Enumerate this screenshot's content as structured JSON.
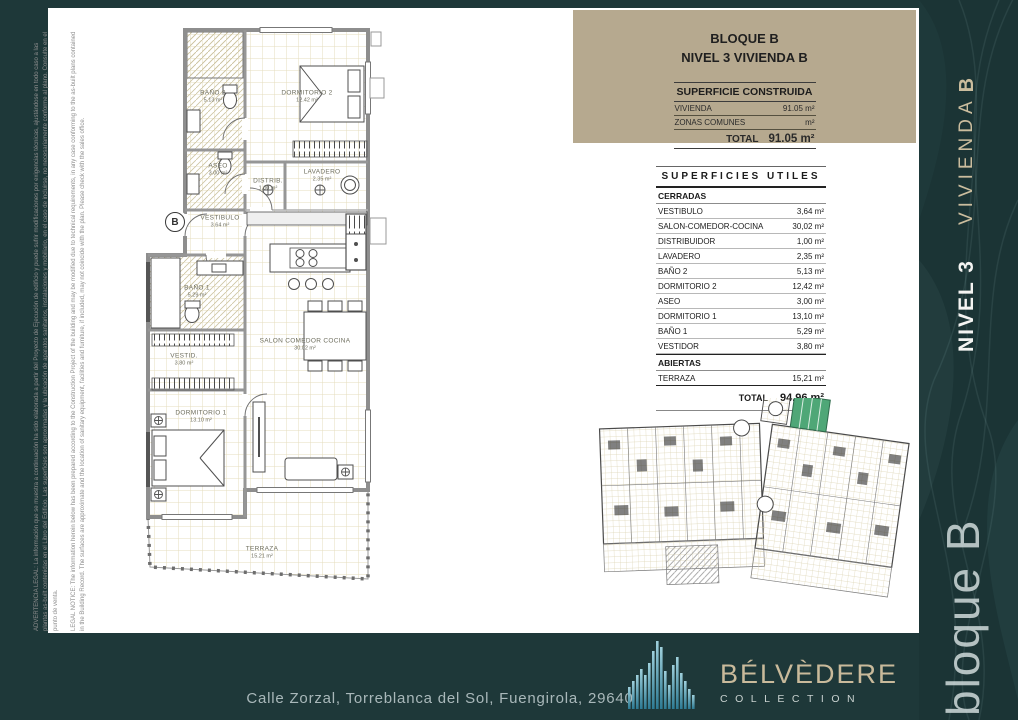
{
  "colors": {
    "teal": "#1e3839",
    "beige": "#b6a98f",
    "highlight_green": "#4fa777"
  },
  "legal": {
    "es": "ADVERTENCIA LEGAL: La información que se muestra a continuación ha sido elaborada a partir del Proyecto de Ejecución de edificio y puede sufrir modificaciones por exigencias técnicas, ajustándose en todo caso a las plantas as-built contenidas en el Libro del Edificio. Las superficies son aproximadas y la ubicación de aparatos sanitarios, instalaciones y mobiliario, en el caso de incluirse, no necesariamente conforme al plano. Consulte en el punto de venta.",
    "en": "LEGAL NOTICE: The information herein below has been prepared according to the Construction Project of the building and may be modified due to technical requirements, in any case conforming to the as-built plans contained in the Building Record. The surfaces are approximate and the location of sanitary equipment, facilities and furniture, if included, may not coincide with the plan. Please check with the sales office."
  },
  "header_box": {
    "title_line1": "BLOQUE B",
    "title_line2": "NIVEL 3 VIVIENDA B",
    "construida": {
      "title": "SUPERFICIE CONSTRUIDA",
      "rows": [
        {
          "label": "VIVIENDA",
          "value": "91.05 m²"
        },
        {
          "label": "ZONAS COMUNES",
          "value": "m²"
        }
      ],
      "total_label": "TOTAL",
      "total_value": "91.05 m²"
    }
  },
  "superficies": {
    "title": "SUPERFICIES UTILES",
    "groups": [
      {
        "name": "CERRADAS",
        "rows": [
          {
            "label": "VESTIBULO",
            "value": "3,64 m²"
          },
          {
            "label": "SALON-COMEDOR-COCINA",
            "value": "30,02 m²"
          },
          {
            "label": "DISTRIBUIDOR",
            "value": "1,00 m²"
          },
          {
            "label": "LAVADERO",
            "value": "2,35 m²"
          },
          {
            "label": "BAÑO 2",
            "value": "5,13 m²"
          },
          {
            "label": "DORMITORIO 2",
            "value": "12,42 m²"
          },
          {
            "label": "ASEO",
            "value": "3,00 m²"
          },
          {
            "label": "DORMITORIO 1",
            "value": "13,10 m²"
          },
          {
            "label": "BAÑO 1",
            "value": "5,29 m²"
          },
          {
            "label": "VESTIDOR",
            "value": "3,80 m²"
          }
        ]
      },
      {
        "name": "ABIERTAS",
        "rows": [
          {
            "label": "TERRAZA",
            "value": "15,21 m²"
          }
        ]
      }
    ],
    "total_label": "TOTAL",
    "total_value": "94.96 m²"
  },
  "plan": {
    "badge": "B",
    "rooms": [
      {
        "name": "BAÑO 2",
        "area": "5.13 m²"
      },
      {
        "name": "DORMITORIO 2",
        "area": "12.42 m²"
      },
      {
        "name": "ASEO",
        "area": "3.00 m²"
      },
      {
        "name": "DISTRIB.",
        "area": "1.00 m²"
      },
      {
        "name": "LAVADERO",
        "area": "2.35 m²"
      },
      {
        "name": "VESTIBULO",
        "area": "3.64 m²"
      },
      {
        "name": "BAÑO 1",
        "area": "5.29 m²"
      },
      {
        "name": "VESTID.",
        "area": "3.80 m²"
      },
      {
        "name": "SALON COMEDOR COCINA",
        "area": "30.02 m²"
      },
      {
        "name": "DORMITORIO 1",
        "area": "13.10 m²"
      },
      {
        "name": "TERRAZA",
        "area": "15.21 m²"
      }
    ]
  },
  "sidebar": {
    "level_label": "NIVEL 3",
    "unit_word": "VIVIENDA",
    "unit_letter": "B",
    "block_label": "bloque B"
  },
  "footer": {
    "address": "Calle Zorzal, Torreblanca del Sol, Fuengirola, 29640",
    "brand": "BÉLVÈDERE",
    "brand_sub": "COLLECTION"
  }
}
